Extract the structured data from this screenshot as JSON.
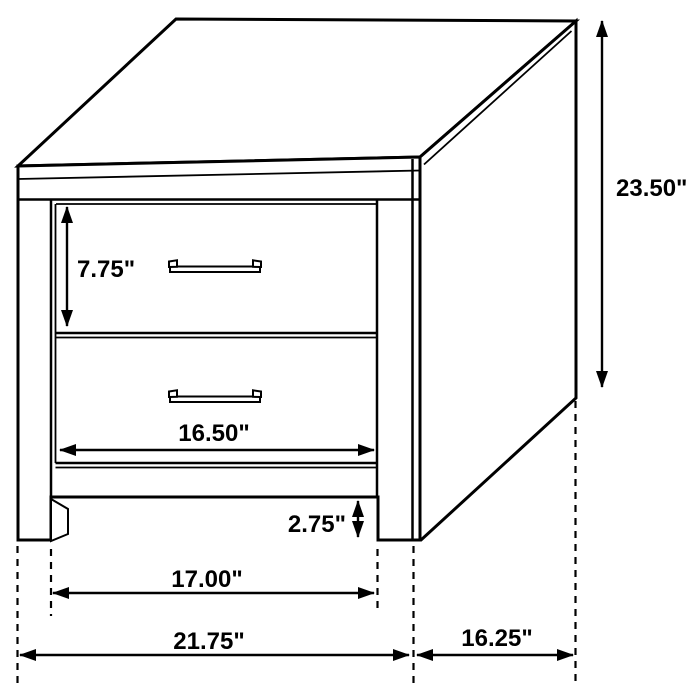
{
  "figure": {
    "type": "furniture-dimension-diagram",
    "subject": "two-drawer nightstand line drawing"
  },
  "labels": {
    "height": "23.50\"",
    "top_drawer_height": "7.75\"",
    "drawer_width": "16.50\"",
    "leg_clearance": "2.75\"",
    "inner_base_width": "17.00\"",
    "overall_width": "21.75\"",
    "depth": "16.25\""
  },
  "colors": {
    "line": "#000000",
    "background": "#ffffff"
  }
}
